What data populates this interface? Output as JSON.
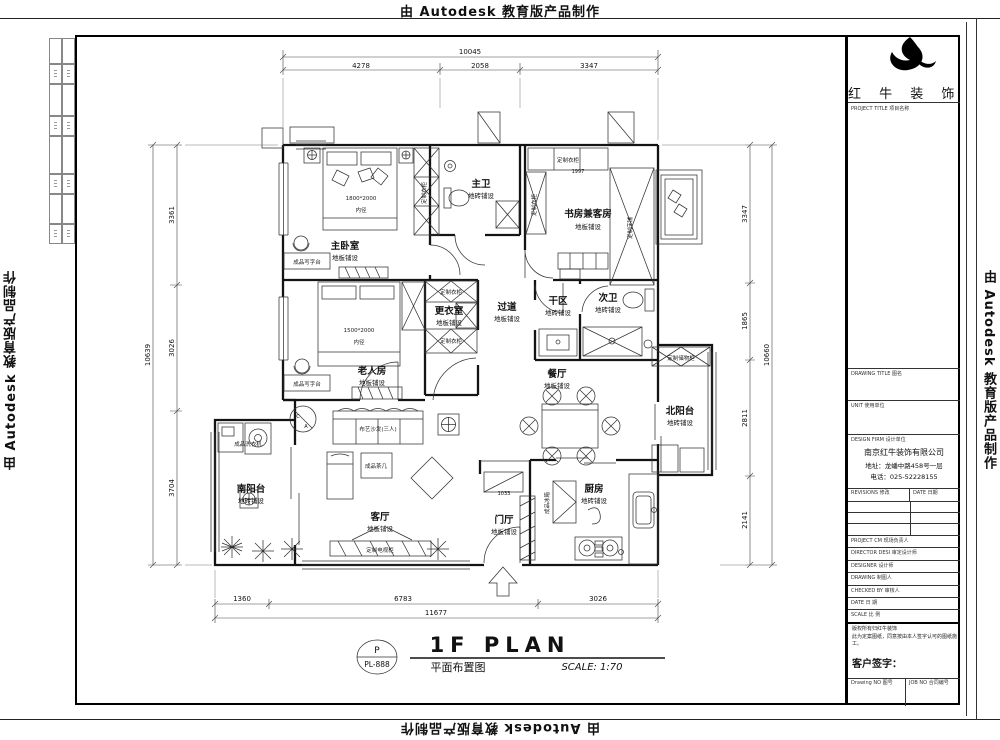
{
  "watermark": {
    "text": "由 Autodesk 教育版产品制作"
  },
  "title_block": {
    "logo_text": "红 牛 装 饰",
    "project_title_label": "PROJECT TITLE 项目名称",
    "drawing_title_label": "DRAWING TITLE 图名",
    "unit_label": "UNIT 使用单位",
    "design_firm_label": "DESIGN FIRM 设计单位",
    "company_name": "南京红牛装饰有限公司",
    "company_address": "地址：龙蟠中路458号一层",
    "company_phone": "电话：025-52228155",
    "revisions_label": "REVISIONS 修改",
    "revision_date_label": "DATE 日期",
    "rows": [
      {
        "label": "PROJECT CM 现场负责人"
      },
      {
        "label": "DIRECTOR DESI 审定设计师"
      },
      {
        "label": "DESIGNER 设计师"
      },
      {
        "label": "DRAWING 制图人"
      },
      {
        "label": "CHECKED BY 审核人"
      },
      {
        "label": "DATE 日 期"
      },
      {
        "label": "SCALE 比 例"
      }
    ],
    "copyright_line1": "版权所有归红牛装饰",
    "copyright_line2": "此为定案图纸，同意按由本人签字认可的图纸施工。",
    "customer_sign_label": "客户签字：",
    "drawing_no_label": "Drawing NO 图号",
    "job_no_label": "JOB NO 合同编号"
  },
  "sheet": {
    "stamp_top": "P",
    "stamp_bottom": "PL-888",
    "title_en": "1F PLAN",
    "title_cn": "平面布置图",
    "scale": "SCALE: 1:70"
  },
  "dimensions": {
    "top": {
      "overall": "10045",
      "segments": [
        "4278",
        "2058",
        "3347"
      ]
    },
    "left": {
      "overall": "10639",
      "segments": [
        "3361",
        "3026",
        "3704"
      ]
    },
    "right": {
      "overall": "10660",
      "segments": [
        "3347",
        "1865",
        "2811",
        "2141"
      ]
    },
    "bottom": {
      "overall": "11677",
      "segments": [
        "1360",
        "6783",
        "3026"
      ]
    },
    "inner": [
      "1997",
      "1033"
    ]
  },
  "plan": {
    "rooms": [
      {
        "name": "主卧室",
        "finish": "地板铺设"
      },
      {
        "name": "主卫",
        "finish": "地砖铺设"
      },
      {
        "name": "书房兼客房",
        "finish": "地板铺设"
      },
      {
        "name": "更衣室",
        "finish": "地板铺设"
      },
      {
        "name": "过道",
        "finish": "地板铺设"
      },
      {
        "name": "干区",
        "finish": "地砖铺设"
      },
      {
        "name": "次卫",
        "finish": "地砖铺设"
      },
      {
        "name": "餐厅",
        "finish": "地板铺设"
      },
      {
        "name": "北阳台",
        "finish": "地砖铺设"
      },
      {
        "name": "老人房",
        "finish": "地板铺设"
      },
      {
        "name": "南阳台",
        "finish": "地砖铺设"
      },
      {
        "name": "客厅",
        "finish": "地板铺设"
      },
      {
        "name": "门厅",
        "finish": "地板铺设"
      },
      {
        "name": "厨房",
        "finish": "地砖铺设"
      }
    ],
    "furniture": [
      "定制衣柜",
      "1800*2000",
      "内径",
      "成品写字台",
      "定制衣柜",
      "定制衣柜",
      "定制床铺",
      "定制衣柜",
      "定制衣柜",
      "1500*2000",
      "内径",
      "成品写字台",
      "成品洗衣机",
      "定制储物柜",
      "布艺沙发(三人)",
      "成品茶几",
      "定制电视柜",
      "成品冰箱"
    ],
    "callout": {
      "top": "C",
      "bottom": "A"
    }
  }
}
